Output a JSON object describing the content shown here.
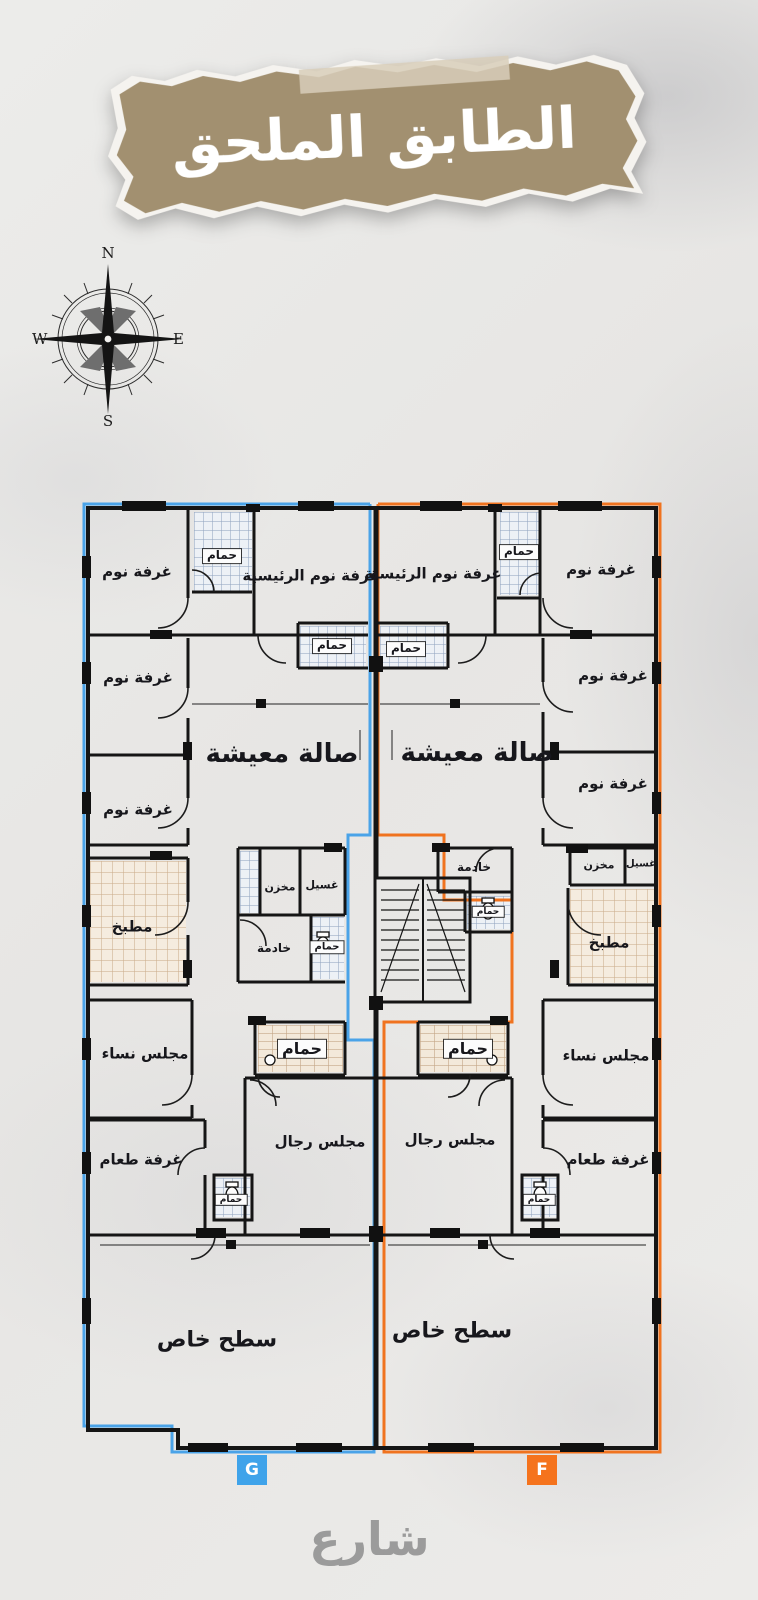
{
  "title_banner": {
    "text": "الطابق الملحق"
  },
  "compass": {
    "north": "N",
    "east": "E",
    "south": "S",
    "west": "W"
  },
  "street": {
    "label": "شارع"
  },
  "badges": {
    "left_unit": "G",
    "right_unit": "F"
  },
  "colors": {
    "banner": "#a29070",
    "unit_g_outline": "#4aa3e8",
    "unit_f_outline": "#f0731f",
    "walls": "#151515",
    "street_text": "#9b9b9b"
  },
  "unit_g": {
    "bedroom_1": "غرفة نوم",
    "bath_top": "حمام",
    "master_bedroom": "غرفة نوم الرئيسية",
    "bath_master": "حمام",
    "bedroom_2": "غرفة نوم",
    "bedroom_3": "غرفة نوم",
    "living": "صالة معيشة",
    "kitchen": "مطبخ",
    "storage": "مخزن",
    "laundry": "غسيل",
    "maid": "خادمة",
    "bath_mid": "حمام",
    "majlis_women": "مجلس نساء",
    "bath_guest": "حمام",
    "dining": "غرفة طعام",
    "majlis_men": "مجلس رجال",
    "bath_small": "حمام",
    "roof": "سطح خاص"
  },
  "unit_f": {
    "master_bedroom": "غرفة نوم الرئيسية",
    "bath_top": "حمام",
    "bedroom_1": "غرفة نوم",
    "bath_master": "حمام",
    "bedroom_2": "غرفة نوم",
    "bedroom_3": "غرفة نوم",
    "living": "صالة معيشة",
    "maid": "خادمة",
    "bath_mid": "حمام",
    "storage": "مخزن",
    "laundry": "غسيل",
    "kitchen": "مطبخ",
    "majlis_women": "مجلس نساء",
    "bath_guest": "حمام",
    "majlis_men": "مجلس رجال",
    "dining": "غرفة طعام",
    "bath_small": "حمام",
    "roof": "سطح خاص"
  }
}
